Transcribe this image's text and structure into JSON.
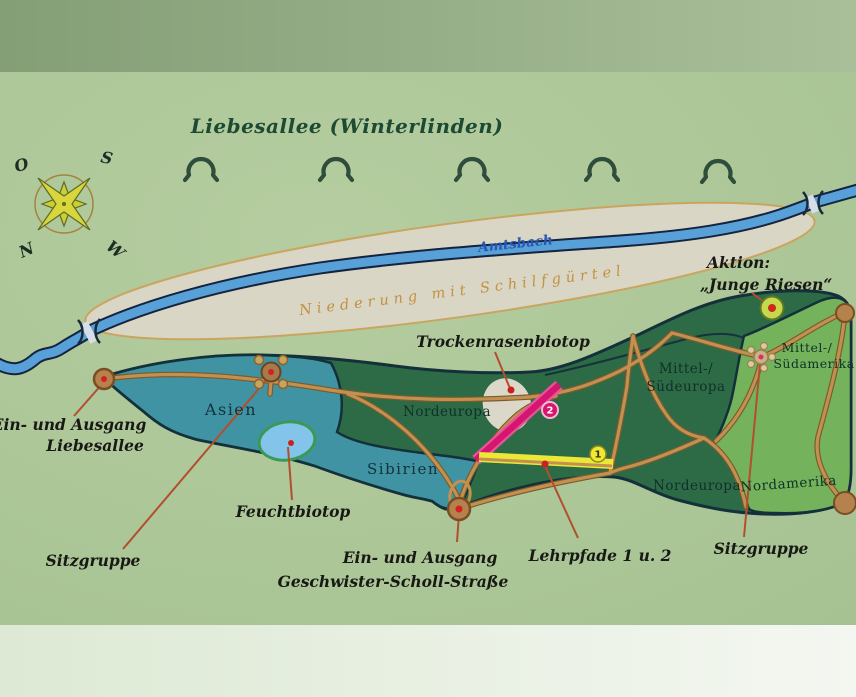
{
  "sign": {
    "title": "Liebesallee (Winterlinden)",
    "tree_symbol_count": 5
  },
  "compass": {
    "north": "N",
    "south": "S",
    "east": "O",
    "west": "W"
  },
  "river": {
    "name": "Amtsbach"
  },
  "lowland": {
    "label": "Niederung mit Schilfgürtel"
  },
  "action_site": {
    "line1": "Aktion:",
    "line2": "„Junge Riesen“"
  },
  "regions": {
    "asien": "Asien",
    "sibirien": "Sibirien",
    "nordeuropa_nw": "Nordeuropa",
    "mittel_sudeuropa_line1": "Mittel-/",
    "mittel_sudeuropa_line2": "Südeuropa",
    "mittel_sudamerika_line1": "Mittel-/",
    "mittel_sudamerika_line2": "Südamerika",
    "nordeuropa_s": "Nordeuropa",
    "nordamerika": "Nordamerika"
  },
  "features": {
    "trockenrasenbiotop": "Trockenrasenbiotop",
    "feuchtbiotop": "Feuchtbiotop",
    "sitzgruppe_left": "Sitzgruppe",
    "sitzgruppe_right": "Sitzgruppe",
    "lehrpfade": "Lehrpfade 1 u. 2",
    "entrance_west_line1": "Ein- und Ausgang",
    "entrance_west_line2": "Liebesallee",
    "entrance_south_line1": "Ein- und Ausgang",
    "entrance_south_line2": "Geschwister-Scholl-Straße"
  },
  "trail_badges": {
    "trail1": "1",
    "trail2": "2"
  },
  "colors": {
    "map_background": "#aec79a",
    "park_dark_green": "#2d6b47",
    "park_light_green": "#74b35b",
    "asia_teal": "#3f93a3",
    "river_blue": "#58a0d8",
    "lowland_beige": "#d9d6c6",
    "path_tan": "#c2914f",
    "trail1_yellow": "#ece838",
    "trail2_magenta": "#d5156e",
    "callout_red": "#b14f2e",
    "pond_blue": "#82c4ea",
    "entrance_brown": "#b5824e",
    "title_green": "#1c4a32",
    "amtsbach_blue": "#2b56b0",
    "niederung_text": "#c3913f"
  }
}
